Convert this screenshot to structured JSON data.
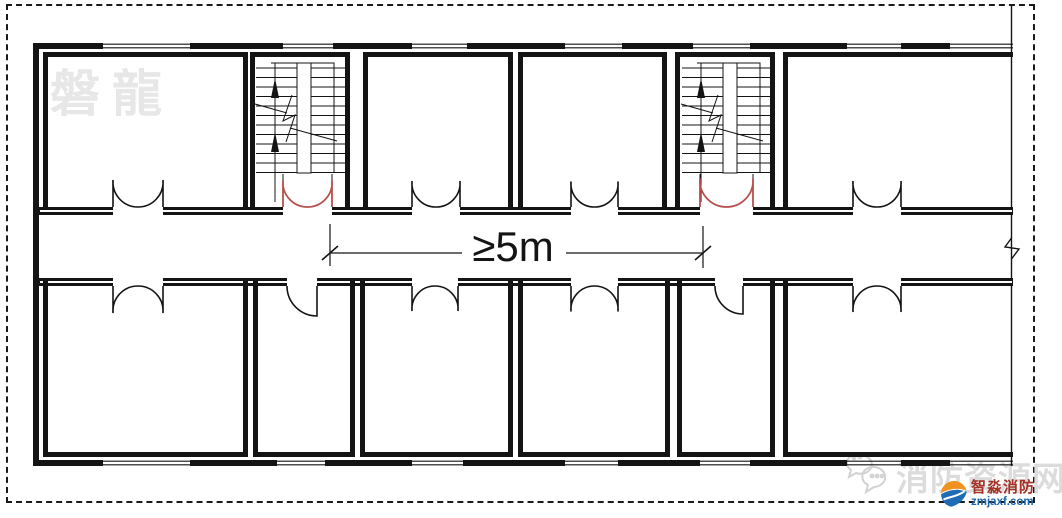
{
  "page": {
    "background": "#ffffff",
    "border_style": "dashed"
  },
  "plan": {
    "type": "building-floor-plan",
    "dimension_label": "≥5m",
    "dimension_meaning": "minimum distance between the two exit (staircase) doors",
    "line_color": "#141414",
    "exit_door_color": "#b5524e",
    "staircase_count": 2,
    "top_room_count": 4,
    "bottom_room_count": 6
  },
  "watermarks": {
    "top_left": "磐龍",
    "bottom_right": "消防资源网"
  },
  "logo": {
    "company": "智淼消防",
    "website": "zmjaxf.com",
    "text_color": "#a33126",
    "website_color": "#1e66ad",
    "icon_orange": "#f0941f",
    "icon_blue": "#1f6cb4"
  }
}
